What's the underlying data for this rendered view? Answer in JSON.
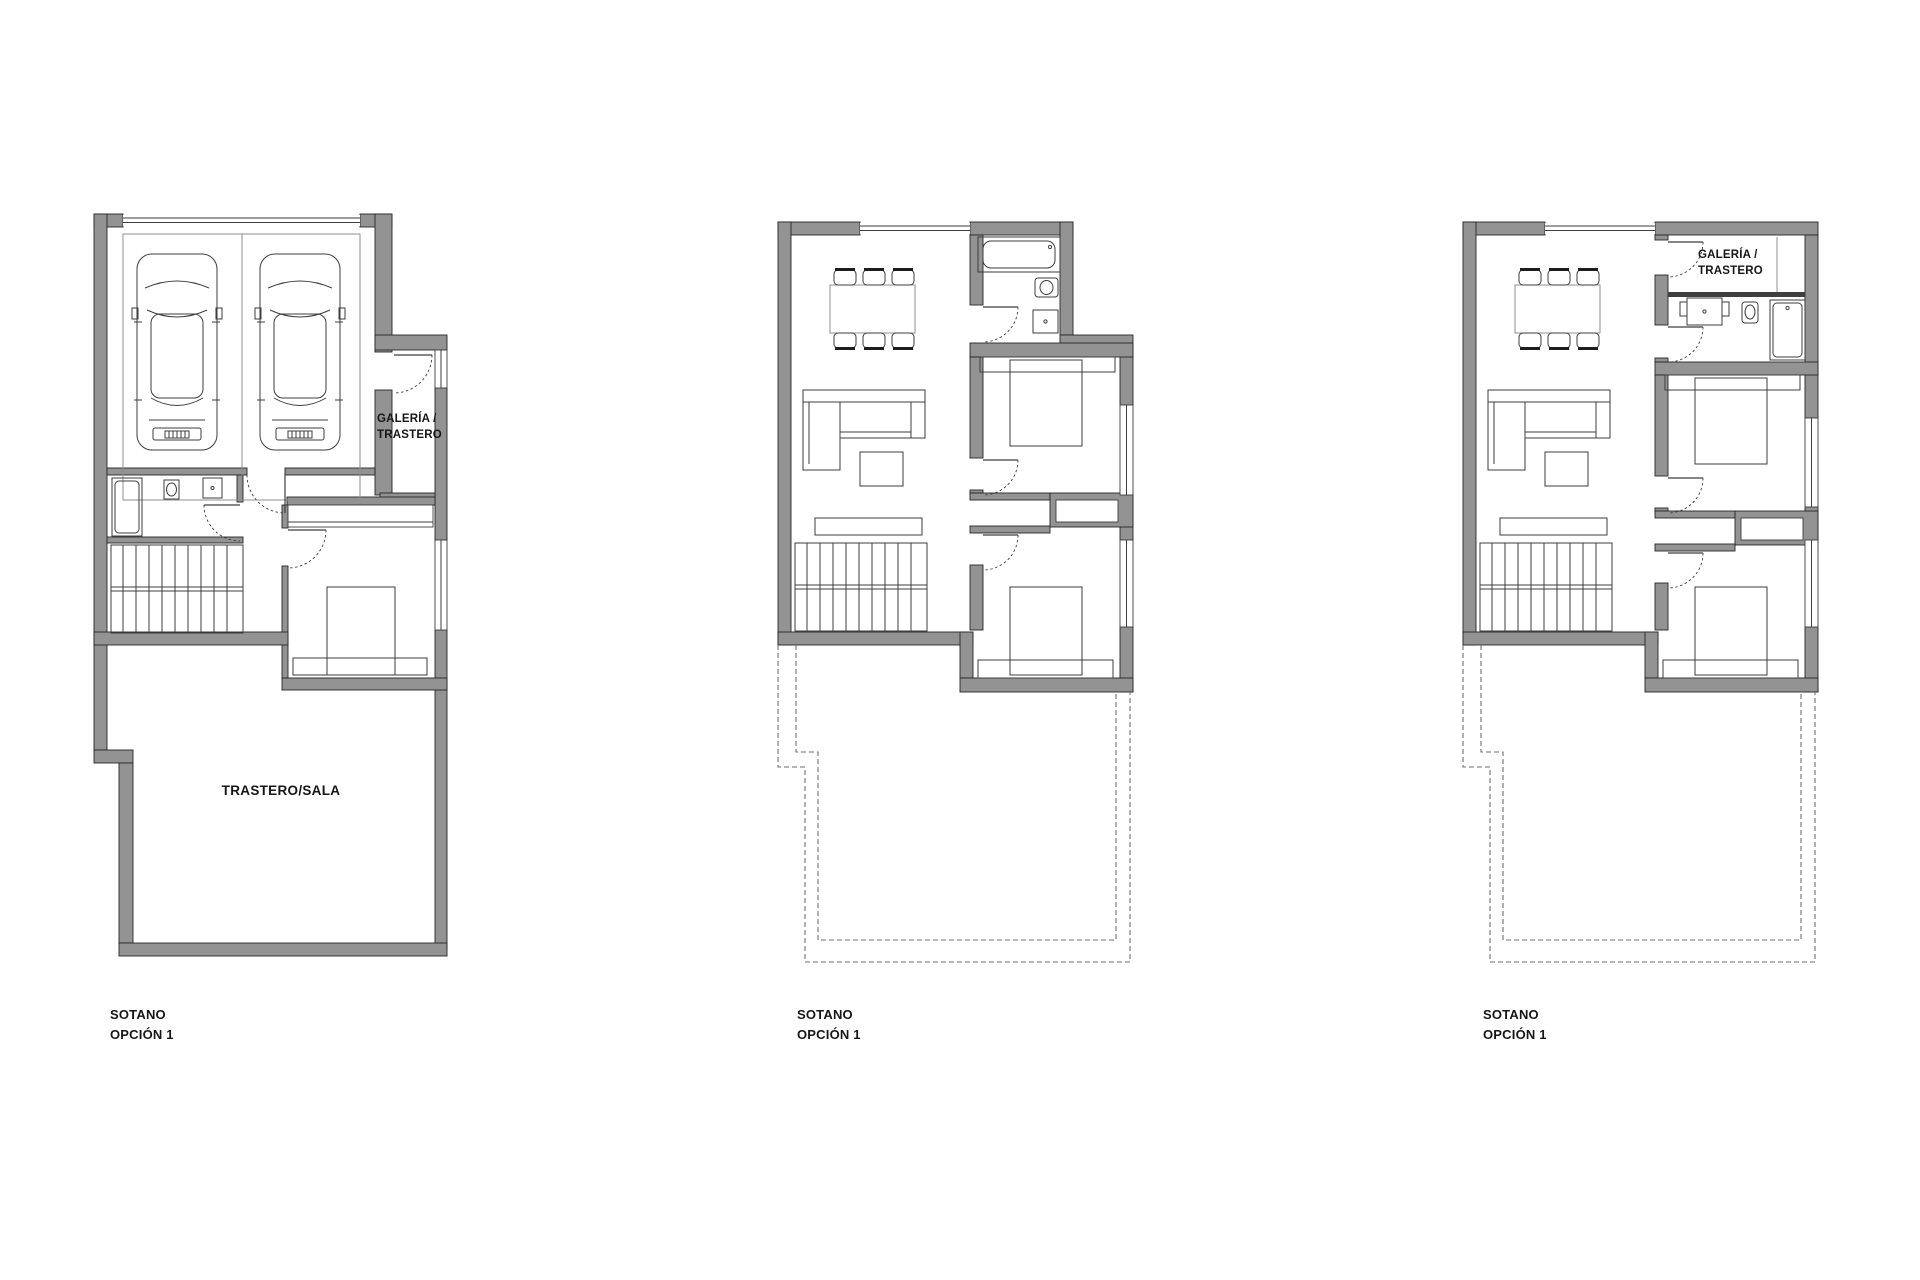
{
  "page": {
    "width": 1920,
    "height": 1280,
    "background": "#ffffff",
    "title": "Basement floor plan options"
  },
  "colors": {
    "wall_fill": "#939393",
    "wall_edge": "#262626",
    "line": "#3d3d3d",
    "line_soft": "#8f8f8f",
    "dashed": "#6f6f6f",
    "text": "#161616",
    "bg": "#ffffff"
  },
  "plans": [
    {
      "id": "left",
      "caption_line1": "SOTANO",
      "caption_line2": "OPCIÓN 1",
      "rooms": {
        "galeria_line1": "GALERÍA /",
        "galeria_line2": "TRASTERO",
        "sala": "TRASTERO/SALA"
      },
      "features": [
        "garage-two-cars",
        "galeria-trastero",
        "bathroom",
        "stairs",
        "bedroom",
        "trastero-sala"
      ]
    },
    {
      "id": "middle",
      "caption_line1": "SOTANO",
      "caption_line2": "OPCIÓN 1",
      "rooms": {},
      "features": [
        "dining-table",
        "sofa",
        "bathroom-with-tub",
        "two-bedrooms",
        "stairs",
        "unexcavated-dashed-area"
      ]
    },
    {
      "id": "right",
      "caption_line1": "SOTANO",
      "caption_line2": "OPCIÓN 1",
      "rooms": {
        "galeria_line1": "GALERÍA /",
        "galeria_line2": "TRASTERO"
      },
      "features": [
        "dining-table",
        "sofa",
        "galeria-trastero",
        "bathroom",
        "two-bedrooms",
        "stairs",
        "unexcavated-dashed-area"
      ]
    }
  ]
}
